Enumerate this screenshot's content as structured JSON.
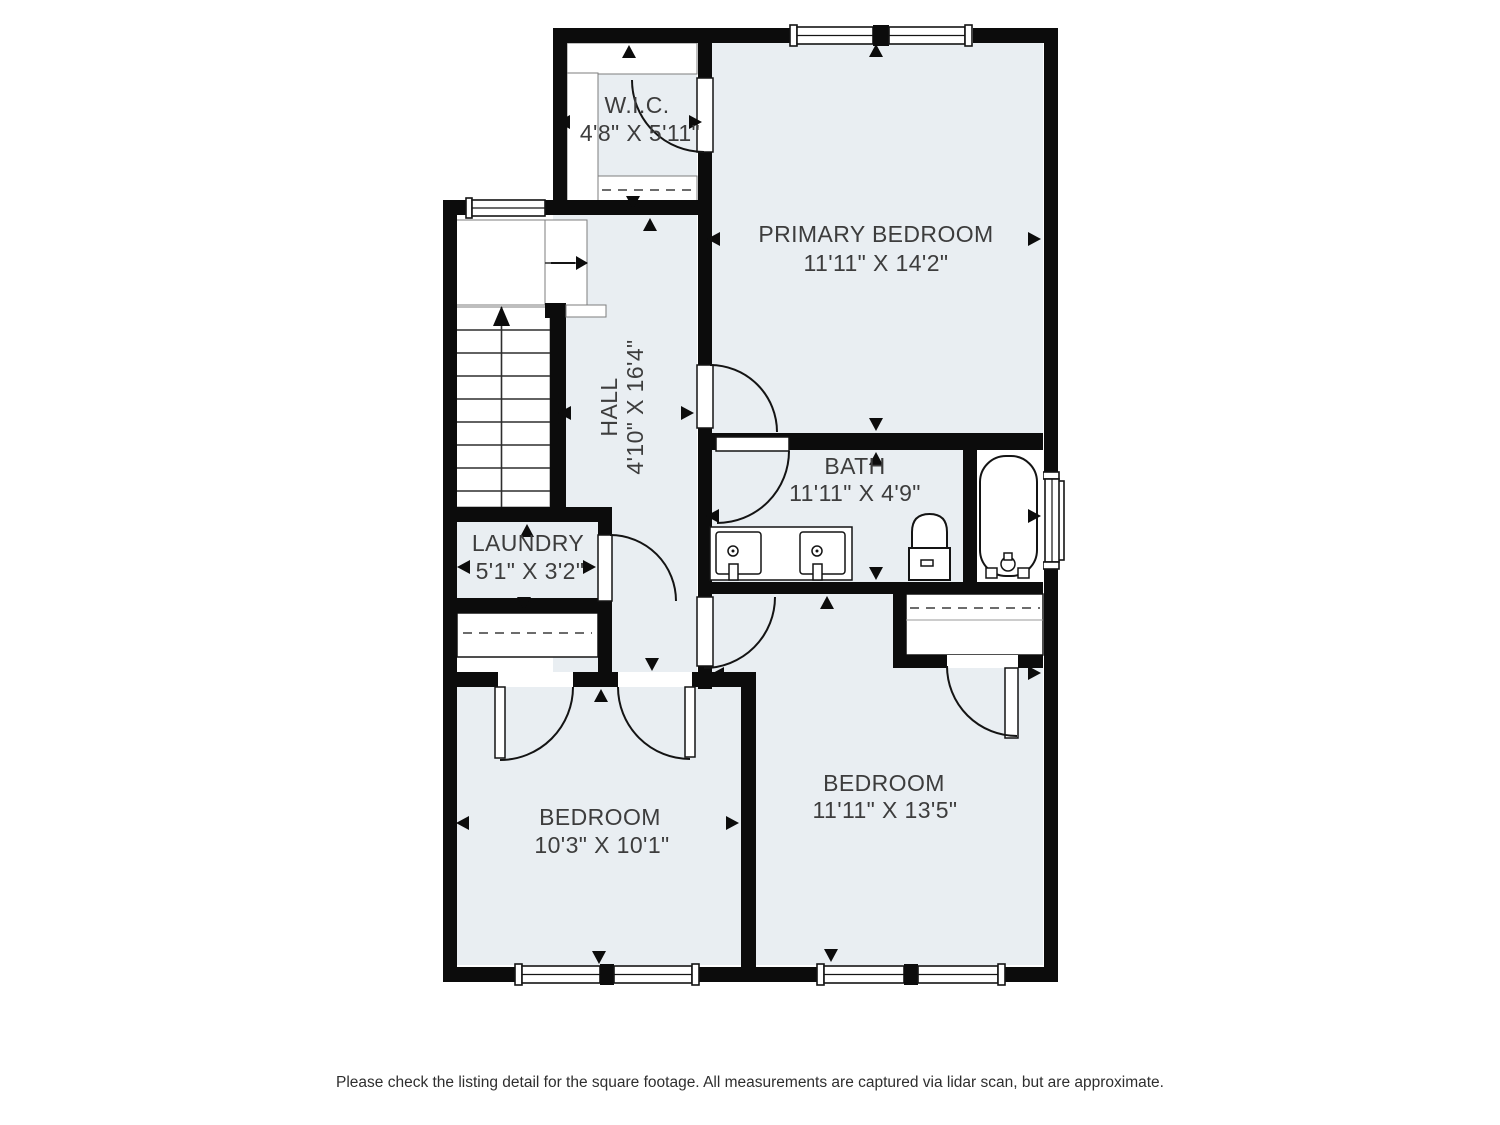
{
  "plan": {
    "rooms": [
      {
        "id": "wic",
        "name": "W.I.C.",
        "dims": "4'8\" X 5'11\""
      },
      {
        "id": "primary-bedroom",
        "name": "PRIMARY BEDROOM",
        "dims": "11'11\" X 14'2\""
      },
      {
        "id": "hall",
        "name": "HALL",
        "dims": "4'10\" X 16'4\""
      },
      {
        "id": "bath",
        "name": "BATH",
        "dims": "11'11\" X 4'9\""
      },
      {
        "id": "laundry",
        "name": "LAUNDRY",
        "dims": "5'1\" X 3'2\""
      },
      {
        "id": "bedroom-left",
        "name": "BEDROOM",
        "dims": "10'3\" X 10'1\""
      },
      {
        "id": "bedroom-right",
        "name": "BEDROOM",
        "dims": "11'11\" X 13'5\""
      }
    ],
    "colors": {
      "wall": "#0c0c0c",
      "floor": "#e9eef2",
      "line": "#141414",
      "text": "#3d3d3d"
    }
  },
  "footer": {
    "disclaimer": "Please check the listing detail for the square footage. All measurements are captured via lidar scan, but are approximate."
  }
}
